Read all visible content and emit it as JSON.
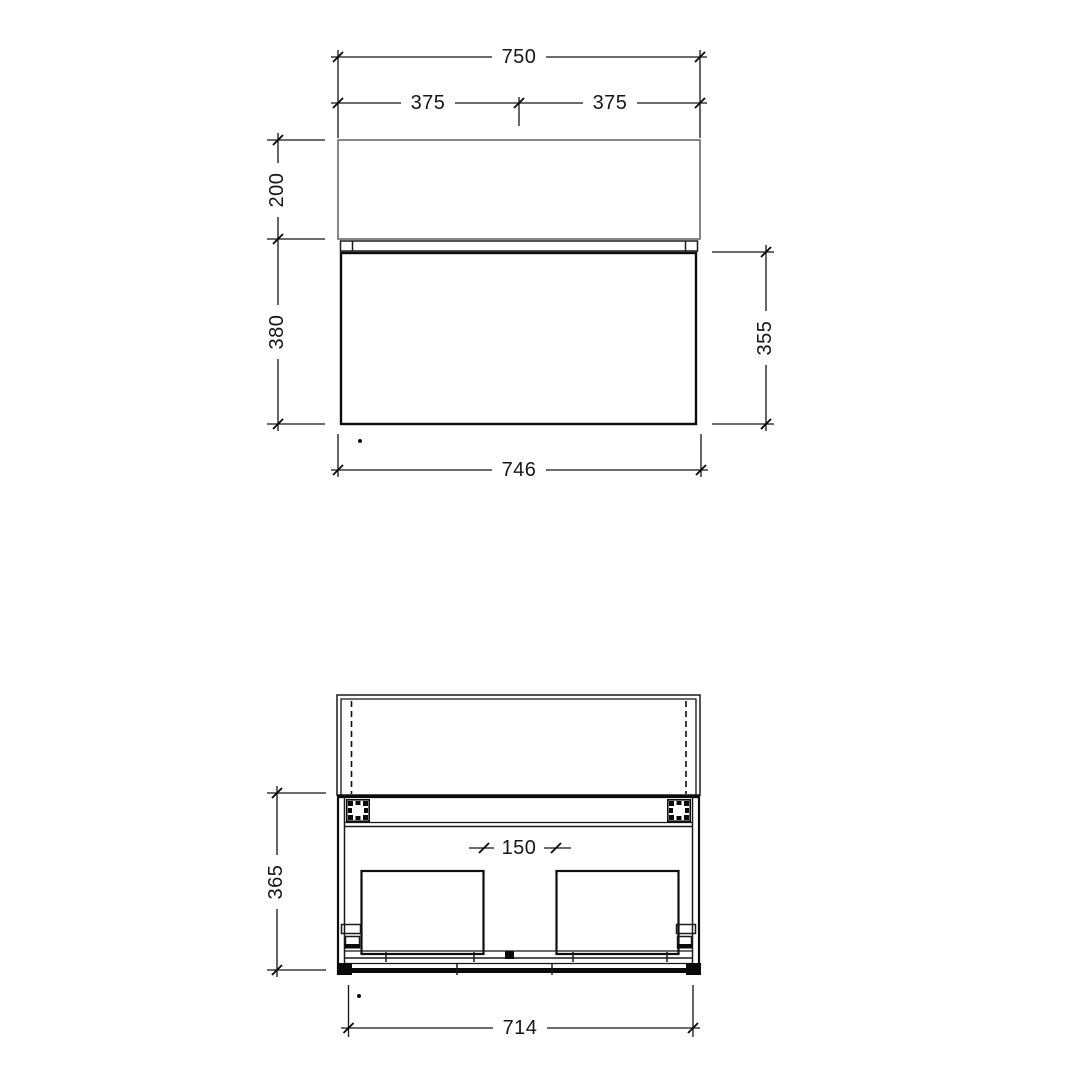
{
  "page": {
    "background": "#ffffff",
    "line_color": "#0d0d0d",
    "light_line_color": "#6b6b6b",
    "text_color": "#161616"
  },
  "front_elevation": {
    "overall_width": "750",
    "left_half_width": "375",
    "right_half_width": "375",
    "top_section_height": "200",
    "cabinet_height": "380",
    "drawer_front_height": "355",
    "bottom_width": "746"
  },
  "plan_section": {
    "center_gap": "150",
    "internal_height": "365",
    "internal_width": "714"
  }
}
